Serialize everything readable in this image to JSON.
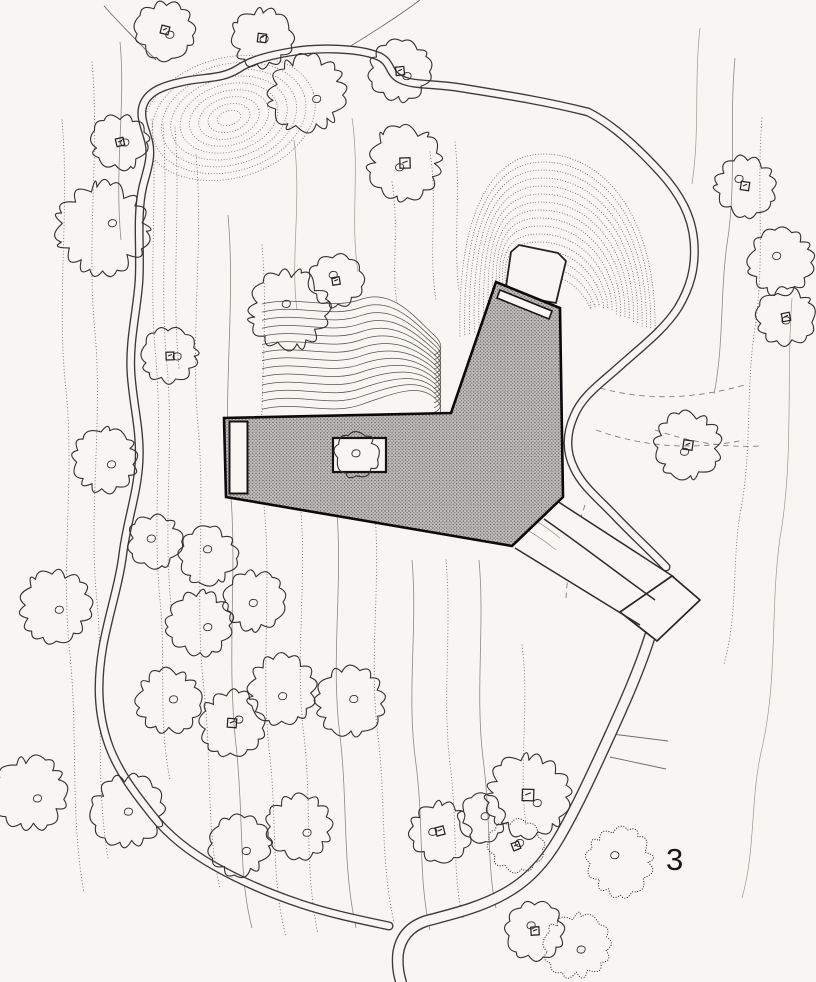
{
  "figure": {
    "label": "3",
    "kind": "architectural site plan"
  },
  "palette": {
    "paper": "#f7f6f2",
    "ink": "#33322e",
    "ink_dark": "#0a0a0a",
    "road": "#3a3a36",
    "building_base": "#c3c2bf",
    "building_dot": "#585855",
    "contour_dot": "#76746e",
    "contour_solid": "#8b8982",
    "contour_faint": "#9b988f",
    "contour_dash": "#7b7973",
    "hair": "#6f6d67",
    "label": "#161614"
  },
  "canvas": {
    "width": 816,
    "height": 982
  },
  "building": {
    "outline": [
      [
        496,
        282
      ],
      [
        560,
        308
      ],
      [
        563,
        497
      ],
      [
        512,
        546
      ],
      [
        226,
        497
      ],
      [
        224,
        418
      ],
      [
        451,
        413
      ]
    ],
    "roof_strip": [
      [
        500,
        290
      ],
      [
        552,
        311
      ],
      [
        549,
        319
      ],
      [
        497,
        298
      ]
    ],
    "courtyard_rect": {
      "x": 229.5,
      "y": 421.5,
      "w": 18,
      "h": 72
    },
    "patio_rect": {
      "x": 333,
      "y": 438,
      "w": 53,
      "h": 34
    },
    "entry_pad": [
      [
        505,
        294
      ],
      [
        511,
        252
      ],
      [
        519,
        245
      ],
      [
        558,
        253
      ],
      [
        566,
        261
      ],
      [
        556,
        303
      ]
    ]
  },
  "roads": [
    {
      "name": "loop-road-west",
      "w": 9,
      "d": "M 588,112 C 540,100 498,94 462,88 C 432,83 414,86 400,79 C 388,73 392,62 378,56 C 358,48 318,47 290,52 C 266,56 250,61 238,69 C 222,79 206,77 186,81 C 166,85 150,90 144,103 C 138,116 146,129 149,143 C 152,158 147,170 143,186 C 136,216 141,250 139,281 C 137,311 129,341 131,373 C 133,405 141,431 139,463 C 137,495 127,521 123,553 C 119,585 109,613 103,646 C 97,681 97,713 109,746 C 119,773 137,796 153,816 C 169,836 191,853 216,867 C 241,881 271,894 301,904 C 331,914 361,920 389,926"
    },
    {
      "name": "east-road",
      "w": 9,
      "d": "M 588,112 C 612,124 638,148 660,172 C 680,194 692,216 694,242 C 696,268 690,288 678,308 C 664,330 640,348 620,366 C 600,384 582,396 574,416 C 566,434 566,452 574,468 C 582,486 600,500 616,517 C 634,536 652,552 666,567"
    },
    {
      "name": "south-road",
      "w": 12,
      "d": "M 650,636 C 640,668 625,702 609,737 C 593,772 577,807 559,838 C 545,862 528,881 504,894 C 479,908 452,914 426,921 C 408,927 400,939 398,954 C 397,967 399,975 401,982"
    }
  ],
  "junction": [
    [
      672,
      576
    ],
    [
      700,
      600
    ],
    [
      657,
      641
    ],
    [
      620,
      612
    ]
  ],
  "driveway": {
    "fills": [
      [
        [
          557,
          501
        ],
        [
          674,
          577
        ],
        [
          655,
          600
        ],
        [
          544,
          519
        ]
      ],
      [
        [
          544,
          519
        ],
        [
          655,
          600
        ],
        [
          640,
          625
        ],
        [
          515,
          548
        ]
      ]
    ],
    "lines": [
      "M 557,501 L 674,577",
      "M 544,519 C 576,541 616,572 655,600",
      "M 515,548 L 640,625"
    ],
    "shade": [
      "M 520,512 C 536,520 548,528 560,538",
      "M 516,524 C 532,532 544,540 556,550"
    ]
  },
  "contours": [
    {
      "s": "dot",
      "d": "M 62,120 C 70,210 56,300 66,390 C 75,480 60,565 70,655 C 78,735 70,815 84,893"
    },
    {
      "s": "dot",
      "d": "M 92,62 C 100,152 86,242 95,332 C 103,422 88,512 97,602 C 105,692 94,775 108,858"
    },
    {
      "s": "solid",
      "d": "M 120,42 C 126,102 114,170 121,240"
    },
    {
      "s": "dot",
      "d": "M 152,120 C 158,200 148,280 156,360 C 163,440 152,520 160,600 C 166,660 158,720 170,780"
    },
    {
      "s": "dot",
      "d": "M 163,125 C 169,205 159,285 167,365 C 174,445 163,525 171,605"
    },
    {
      "s": "dot",
      "d": "M 175,128 C 181,208 171,288 179,368"
    },
    {
      "s": "dot",
      "d": "M 196,155 C 204,245 190,335 198,425 C 206,515 194,600 204,690 C 212,765 206,830 220,888"
    },
    {
      "s": "solid",
      "d": "M 228,215 C 236,305 222,395 230,485 C 238,570 226,655 236,745 C 244,815 238,875 252,928"
    },
    {
      "s": "dot",
      "d": "M 262,245 C 270,335 256,420 264,505 C 272,590 260,675 270,758 C 277,822 271,882 286,936"
    },
    {
      "s": "faint",
      "d": "M 294,140 C 302,200 290,260 297,310"
    },
    {
      "s": "dot",
      "d": "M 300,500 C 308,580 294,658 304,736 C 312,806 304,868 318,934"
    },
    {
      "s": "solid",
      "d": "M 336,502 C 344,580 330,658 340,736 C 348,804 342,864 356,928"
    },
    {
      "s": "dot",
      "d": "M 374,502 C 382,580 368,658 378,736 C 386,802 380,860 394,922"
    },
    {
      "s": "solid",
      "d": "M 412,560 C 418,628 406,696 416,764 C 424,826 418,878 430,930"
    },
    {
      "s": "dot",
      "d": "M 446,560 C 452,628 442,696 450,764 C 458,826 452,876 463,918"
    },
    {
      "s": "solid",
      "d": "M 479,560 C 485,626 475,692 483,758 C 491,820 487,868 496,908"
    },
    {
      "s": "dot",
      "d": "M 522,645 C 530,705 518,765 526,825"
    },
    {
      "s": "faint",
      "d": "M 352,118 C 360,170 350,222 358,272"
    },
    {
      "s": "dot",
      "d": "M 392,182 C 400,232 390,278 398,305"
    },
    {
      "s": "dot",
      "d": "M 430,152 C 438,202 428,252 436,300"
    },
    {
      "s": "dot",
      "d": "M 455,142 C 461,192 453,242 459,292"
    },
    {
      "s": "faint",
      "d": "M 700,28 C 694,80 700,132 692,184"
    },
    {
      "s": "solid",
      "d": "M 735,58 C 729,120 737,182 727,244 C 720,294 724,344 714,394"
    },
    {
      "s": "dot",
      "d": "M 762,118 C 756,190 766,262 754,334 C 746,394 752,454 740,514 C 732,564 738,614 724,664"
    },
    {
      "s": "faint",
      "d": "M 792,298 C 786,378 794,458 780,538 C 770,608 778,678 762,748 C 750,798 756,848 742,898"
    },
    {
      "s": "dash",
      "d": "M 600,388 C 650,402 700,398 748,384"
    },
    {
      "s": "dash",
      "d": "M 596,430 C 646,448 696,450 744,440"
    },
    {
      "s": "dash",
      "d": "M 655,430 C 690,442 725,448 760,446"
    },
    {
      "s": "dash",
      "d": "M 585,505 C 575,535 568,565 566,598"
    },
    {
      "s": "hair",
      "d": "M 604,733 L 668,741"
    },
    {
      "s": "hair",
      "d": "M 610,757 L 666,769"
    },
    {
      "s": "hair",
      "d": "M 420,0 C 396,18 370,34 346,49"
    },
    {
      "s": "hair",
      "d": "M 104,6 C 120,24 138,42 156,60"
    }
  ],
  "hatch_bowl": {
    "count": 16,
    "lx0": 460,
    "lxStep": 4.8,
    "rx0": 655,
    "rxStep": 4.3,
    "ty0": 154,
    "tyStep": 8.0,
    "lb0": 336,
    "lbStep": 1.4,
    "rb0": 332,
    "rbStep": 2.0,
    "mid": 544
  },
  "hatch_knoll": {
    "cx": 229,
    "cy": 118,
    "rot": -16,
    "count": 9,
    "rx0": 88,
    "rxStep": 9.5,
    "ry0": 60,
    "ryStep": 6.6
  },
  "hatch_swirl": {
    "x0": 262,
    "count": 14,
    "y0": 304,
    "dy": 8.1,
    "ye0": 347,
    "dye": 4.8
  },
  "trees": [
    [
      165,
      30,
      27,
      1,
      0
    ],
    [
      262,
      38,
      28,
      1,
      0
    ],
    [
      307,
      94,
      36,
      0,
      0
    ],
    [
      400,
      71,
      28,
      1,
      0
    ],
    [
      405,
      163,
      34,
      1,
      0
    ],
    [
      120,
      142,
      26,
      1,
      0
    ],
    [
      102,
      228,
      42,
      0,
      0
    ],
    [
      745,
      186,
      28,
      1,
      0
    ],
    [
      781,
      262,
      30,
      0,
      0
    ],
    [
      786,
      317,
      27,
      1,
      0
    ],
    [
      336,
      281,
      25,
      1,
      0
    ],
    [
      289,
      310,
      37,
      0,
      0
    ],
    [
      170,
      356,
      26,
      1,
      0
    ],
    [
      105,
      461,
      30,
      0,
      0
    ],
    [
      688,
      445,
      31,
      1,
      0
    ],
    [
      55,
      606,
      33,
      0,
      0
    ],
    [
      155,
      541,
      25,
      0,
      0
    ],
    [
      208,
      556,
      27,
      0,
      0
    ],
    [
      200,
      623,
      30,
      0,
      0
    ],
    [
      254,
      601,
      28,
      0,
      0
    ],
    [
      282,
      689,
      32,
      0,
      0
    ],
    [
      168,
      701,
      30,
      0,
      0
    ],
    [
      232,
      723,
      30,
      1,
      0
    ],
    [
      128,
      811,
      33,
      0,
      0
    ],
    [
      30,
      793,
      34,
      0,
      0
    ],
    [
      350,
      701,
      32,
      0,
      0
    ],
    [
      240,
      846,
      28,
      0,
      0
    ],
    [
      300,
      826,
      30,
      0,
      0
    ],
    [
      440,
      831,
      28,
      1,
      0
    ],
    [
      528,
      795,
      38,
      1,
      0
    ],
    [
      482,
      818,
      22,
      0,
      0
    ],
    [
      516,
      846,
      25,
      1,
      1
    ],
    [
      620,
      862,
      31,
      0,
      1
    ],
    [
      535,
      931,
      27,
      1,
      0
    ],
    [
      577,
      946,
      30,
      0,
      1
    ],
    [
      357,
      455,
      21,
      0,
      0
    ]
  ]
}
